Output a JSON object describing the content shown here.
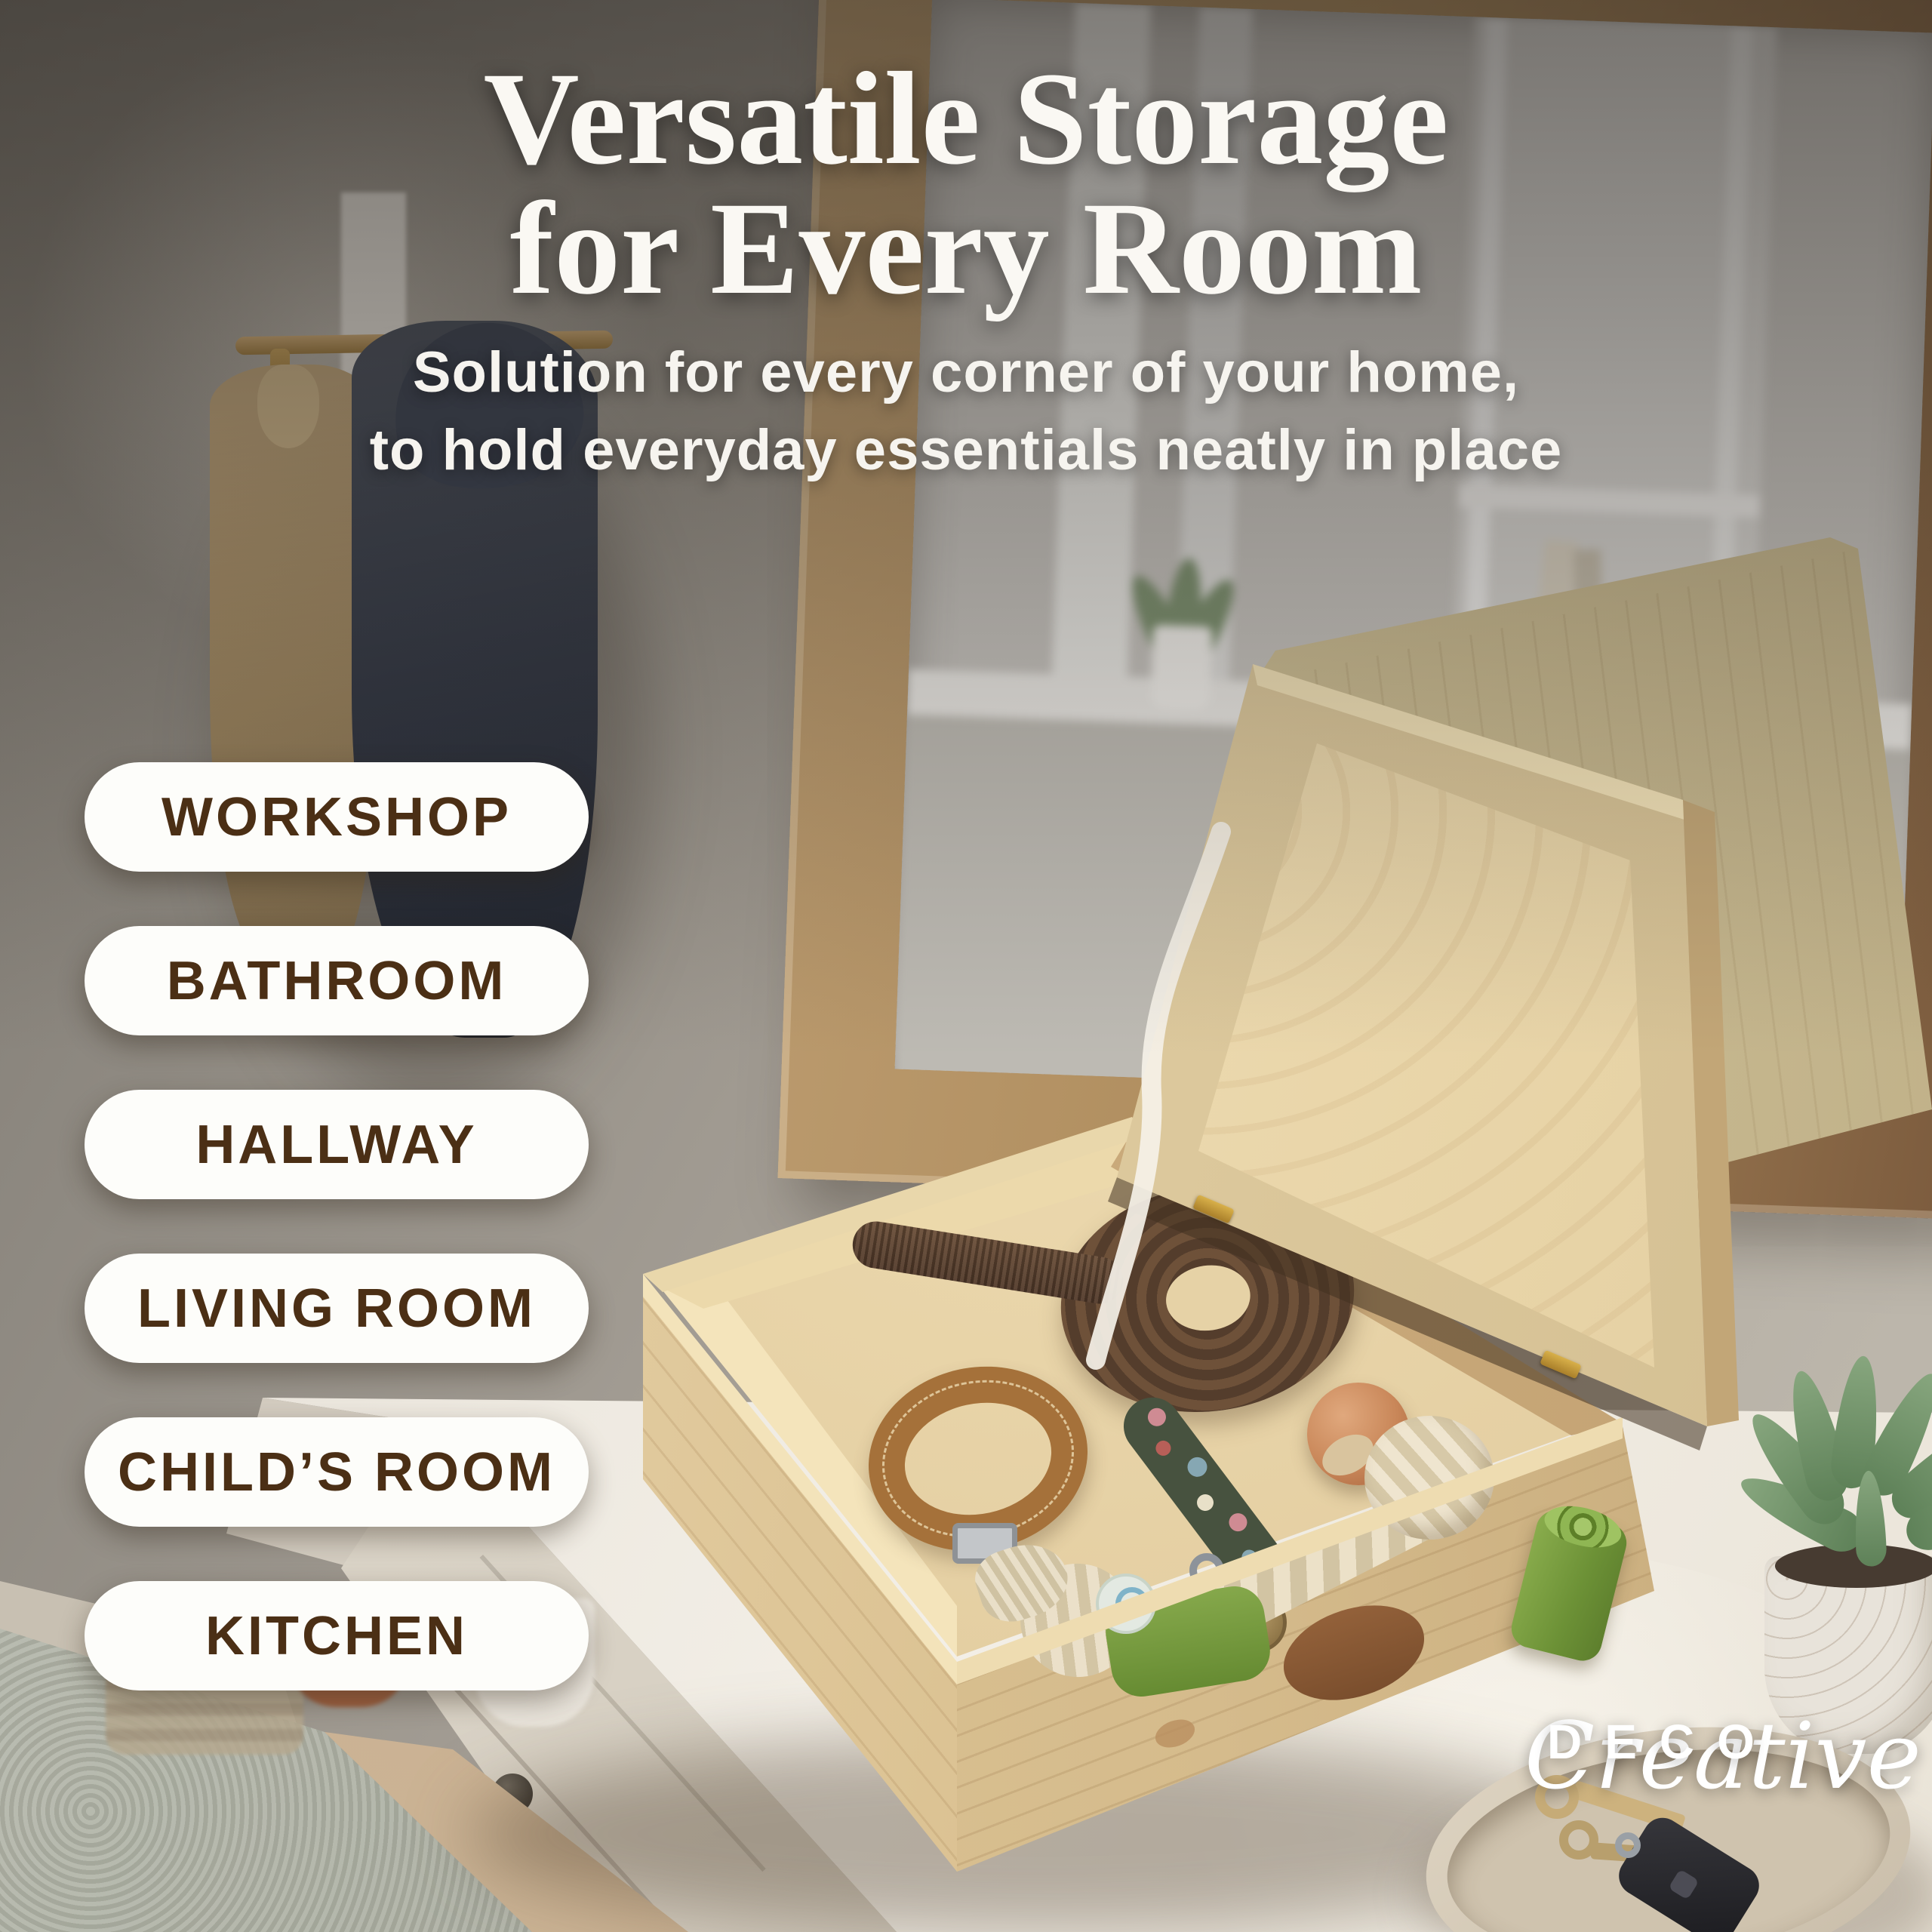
{
  "title": {
    "line1": "Versatile Storage",
    "line2": "for Every Room"
  },
  "subtitle": {
    "line1": "Solution for every corner of your home,",
    "line2": "to hold everyday essentials neatly in place"
  },
  "room_labels": [
    "WORKSHOP",
    "BATHROOM",
    "HALLWAY",
    "LIVING ROOM",
    "CHILD’S ROOM",
    "KITCHEN"
  ],
  "logo": {
    "script": "Creative",
    "caps": "DECO"
  },
  "colors": {
    "pill_background": "#fdfdfa",
    "pill_text": "#4b2f15",
    "headline_text": "#faf8f3",
    "subtitle_text": "#f6f4ef",
    "logo_text": "#ffffff",
    "pine_wood": "#e3cfa3",
    "oak_frame": "#a9875d",
    "waste_bag_green": "#6c9136"
  }
}
